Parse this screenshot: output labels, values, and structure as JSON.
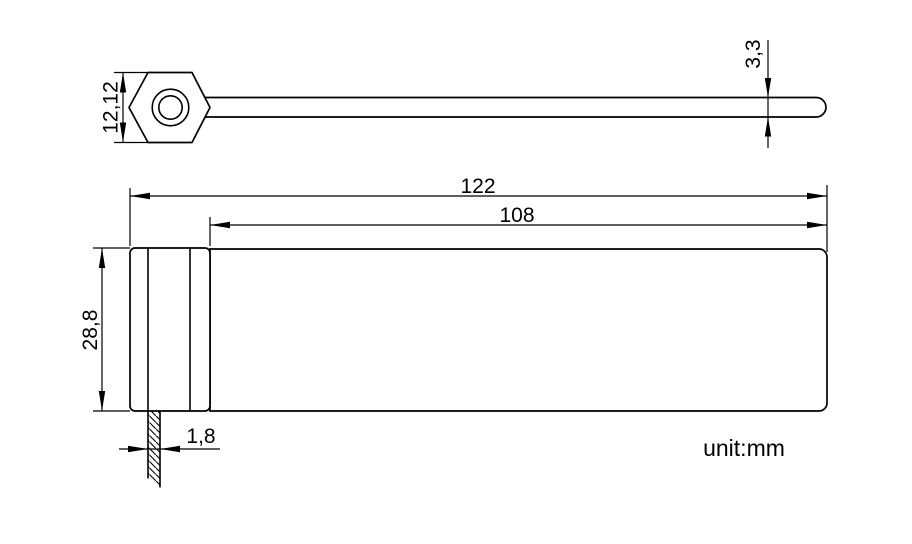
{
  "colors": {
    "background": "#ffffff",
    "line": "#000000",
    "text": "#000000"
  },
  "note": {
    "unit_label": "unit:mm"
  },
  "side_view": {
    "description": "seal side profile with hexagonal head and strap",
    "dimensions": {
      "head_height": "12,12",
      "strap_tip_thickness": "3,3"
    }
  },
  "front_view": {
    "description": "seal front face with lock body and hatched tail",
    "dimensions": {
      "overall_length": "122",
      "strap_length": "108",
      "body_height": "28,8",
      "tail_width": "1,8"
    }
  }
}
